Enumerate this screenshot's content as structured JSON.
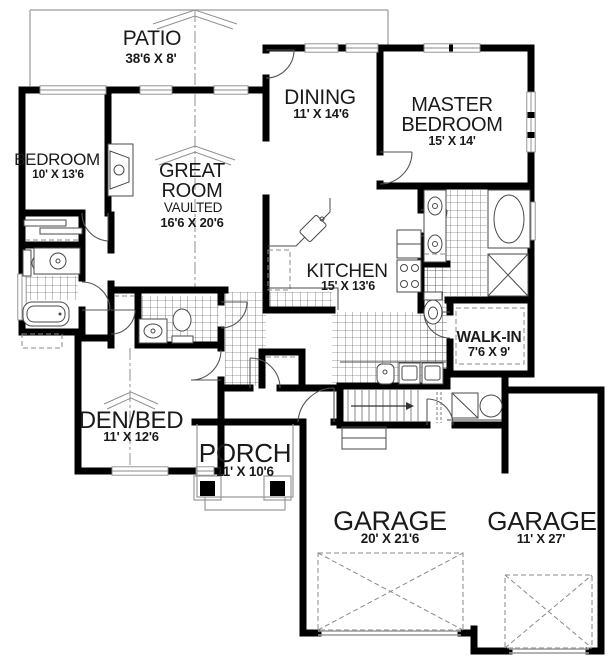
{
  "palette": {
    "background": "#ffffff",
    "wall_color": "#000000",
    "thin_line_color": "#9a9a9a",
    "fixture_line_color": "#4a4a4a",
    "text_color": "#1a1a1a"
  },
  "rooms": {
    "patio": {
      "name": "PATIO",
      "dims": "38'6 X 8'"
    },
    "dining": {
      "name": "DINING",
      "dims": "11' X 14'6"
    },
    "master_bedroom": {
      "name_line1": "MASTER",
      "name_line2": "BEDROOM",
      "dims": "15' X 14'"
    },
    "bedroom": {
      "name": "BEDROOM",
      "dims": "10' X 13'6"
    },
    "great_room": {
      "name_line1": "GREAT",
      "name_line2": "ROOM",
      "note": "VAULTED",
      "dims": "16'6 X 20'6"
    },
    "kitchen": {
      "name": "KITCHEN",
      "dims": "15' X 13'6"
    },
    "walk_in": {
      "name": "WALK-IN",
      "dims": "7'6 X 9'"
    },
    "den_bed": {
      "name": "DEN/BED",
      "dims": "11' X 12'6"
    },
    "porch": {
      "name": "PORCH",
      "dims": "11' X 10'6"
    },
    "garage_main": {
      "name": "GARAGE",
      "dims": "20' X 21'6"
    },
    "garage_side": {
      "name": "GARAGE",
      "dims": "11' X 27'"
    }
  }
}
